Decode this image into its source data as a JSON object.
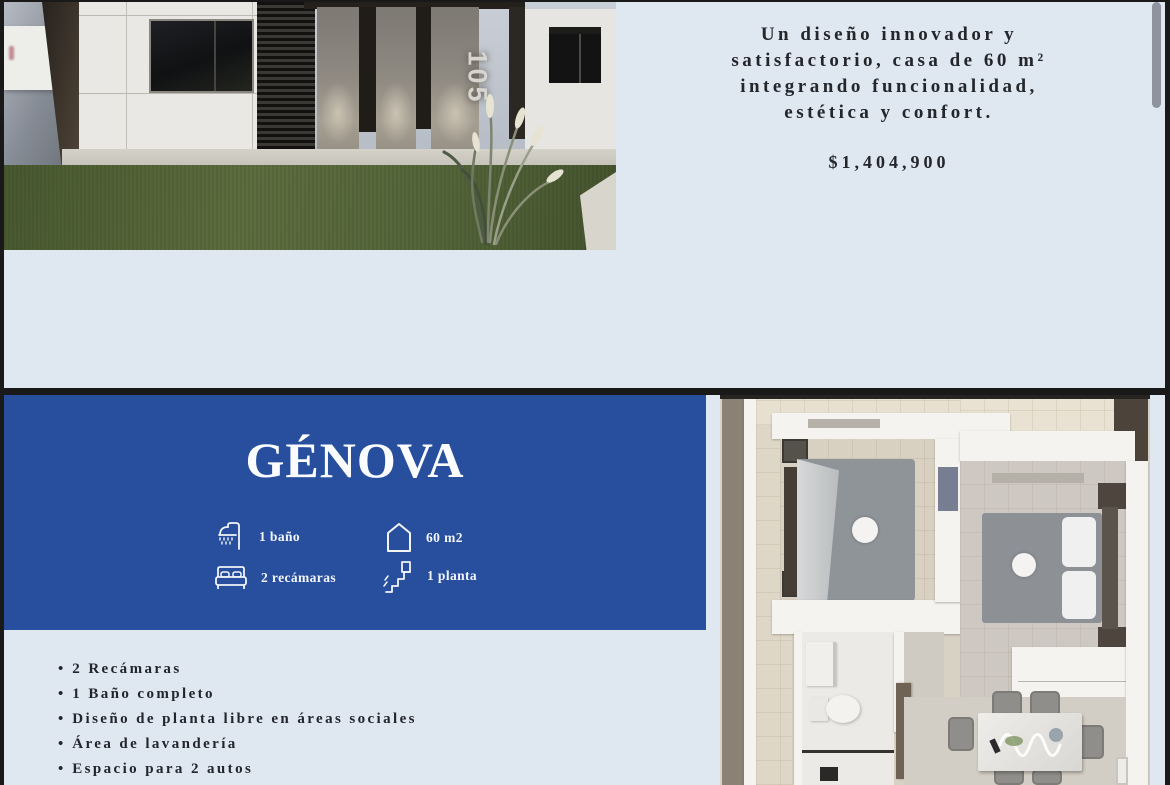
{
  "colors": {
    "accent_blue": "#274f9e",
    "page_bg": "#dfe7f1",
    "frame": "#191919",
    "text": "#23262b"
  },
  "page1": {
    "headline": [
      "Un diseño innovador y",
      "satisfactorio, casa de 60 m²",
      "integrando funcionalidad,",
      "estética y confort."
    ],
    "price": "$1,404,900",
    "house_number": "105"
  },
  "page2": {
    "title": "GÉNOVA",
    "features": [
      {
        "icon": "shower-icon",
        "label": "1 baño"
      },
      {
        "icon": "house-icon",
        "label": "60 m2"
      },
      {
        "icon": "bed-icon",
        "label": "2 recámaras"
      },
      {
        "icon": "stairs-icon",
        "label": "1 planta"
      }
    ],
    "bullets": [
      "2 Recámaras",
      "1 Baño completo",
      "Diseño de planta libre en áreas sociales",
      "Área de lavandería",
      "Espacio para 2 autos"
    ]
  }
}
